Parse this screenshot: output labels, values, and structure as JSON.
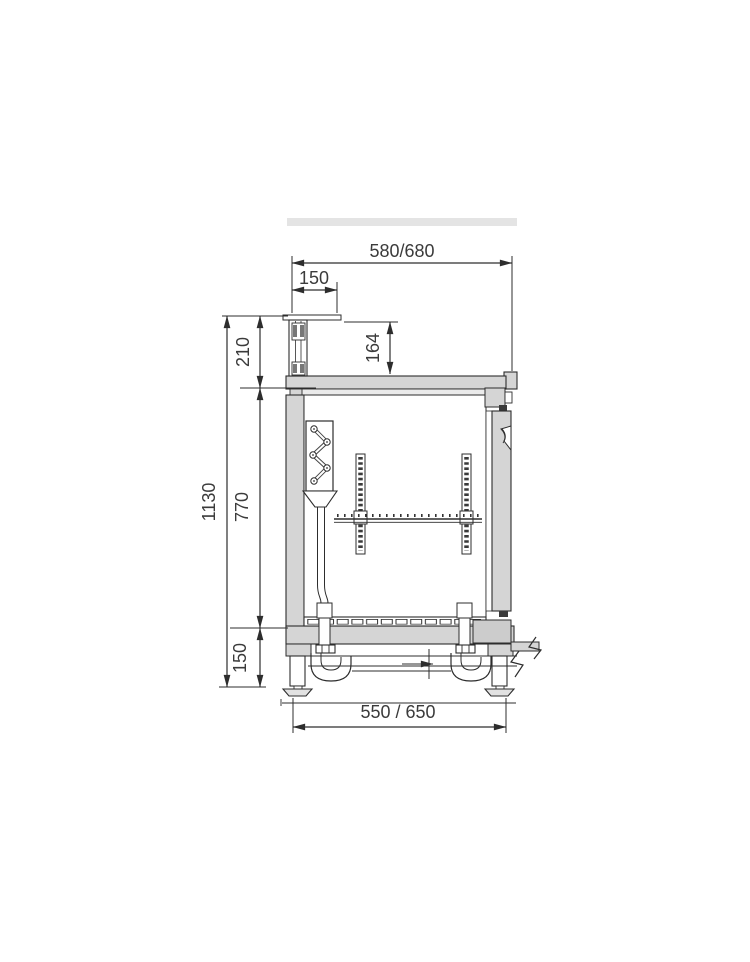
{
  "page": {
    "background": "#ffffff"
  },
  "drawing": {
    "kind": "side cross-section technical drawing of a refrigerated bar counter",
    "colors": {
      "line": "#2d2d2d",
      "panel_fill": "#d5d5d5",
      "accent_bar_fill": "#e4e4e4",
      "text": "#3b3b3b"
    },
    "dimensions": {
      "top_width": "580/680",
      "worktop_overhang": "150",
      "upstand_height": "210",
      "top_shelf_drop": "164",
      "total_height": "1130",
      "body_height": "770",
      "leg_height": "150",
      "base_depth": "550 / 650"
    }
  }
}
